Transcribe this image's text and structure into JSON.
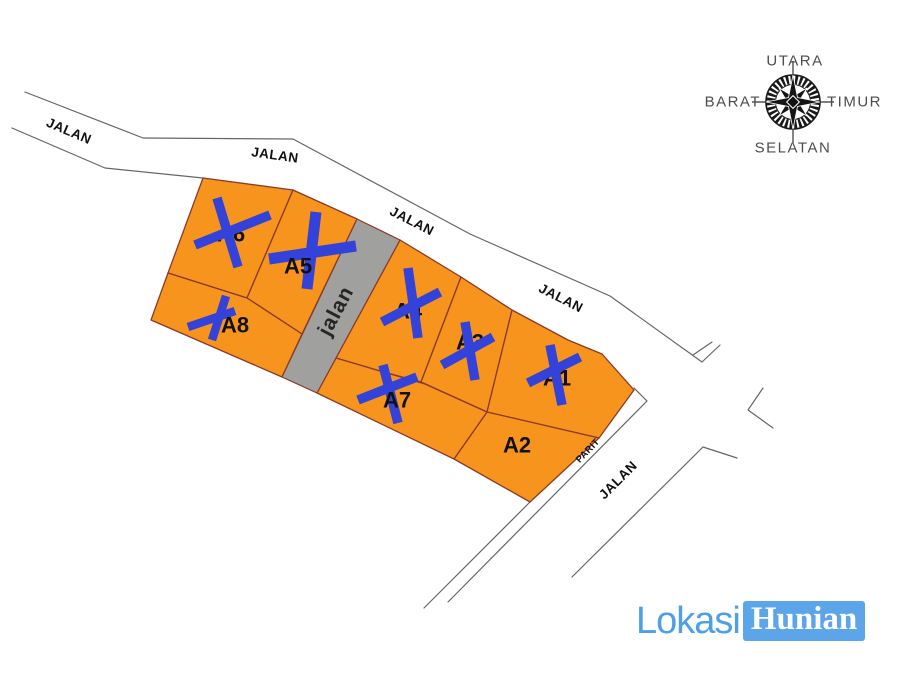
{
  "map": {
    "plots": [
      {
        "label": "A1",
        "status": "sold"
      },
      {
        "label": "A2",
        "status": "available"
      },
      {
        "label": "A3",
        "status": "sold"
      },
      {
        "label": "A4",
        "status": "sold"
      },
      {
        "label": "A5",
        "status": "sold"
      },
      {
        "label": "A6",
        "status": "sold"
      },
      {
        "label": "A7",
        "status": "sold"
      },
      {
        "label": "A8",
        "status": "sold"
      }
    ],
    "road_labels": [
      "JALAN",
      "JALAN",
      "JALAN",
      "JALAN",
      "JALAN"
    ],
    "lane_label": "jalan",
    "ditch_label": "PARIT"
  },
  "compass": {
    "north": "UTARA",
    "east": "TIMUR",
    "south": "SELATAN",
    "west": "BARAT"
  },
  "logo": {
    "primary": "Lokasi",
    "secondary": "Hunian"
  },
  "colors": {
    "plot_fill": "#F7941D",
    "plot_border": "#8B3A2A",
    "sold_mark": "#3342D9",
    "lane_fill": "#A0A09E",
    "road_line": "#666666",
    "label_text": "#111111",
    "lane_text": "#262626",
    "compass_text": "#4D4D4D",
    "logo_text": "#4D9FE8",
    "logo_box": "#5BA5E8"
  }
}
